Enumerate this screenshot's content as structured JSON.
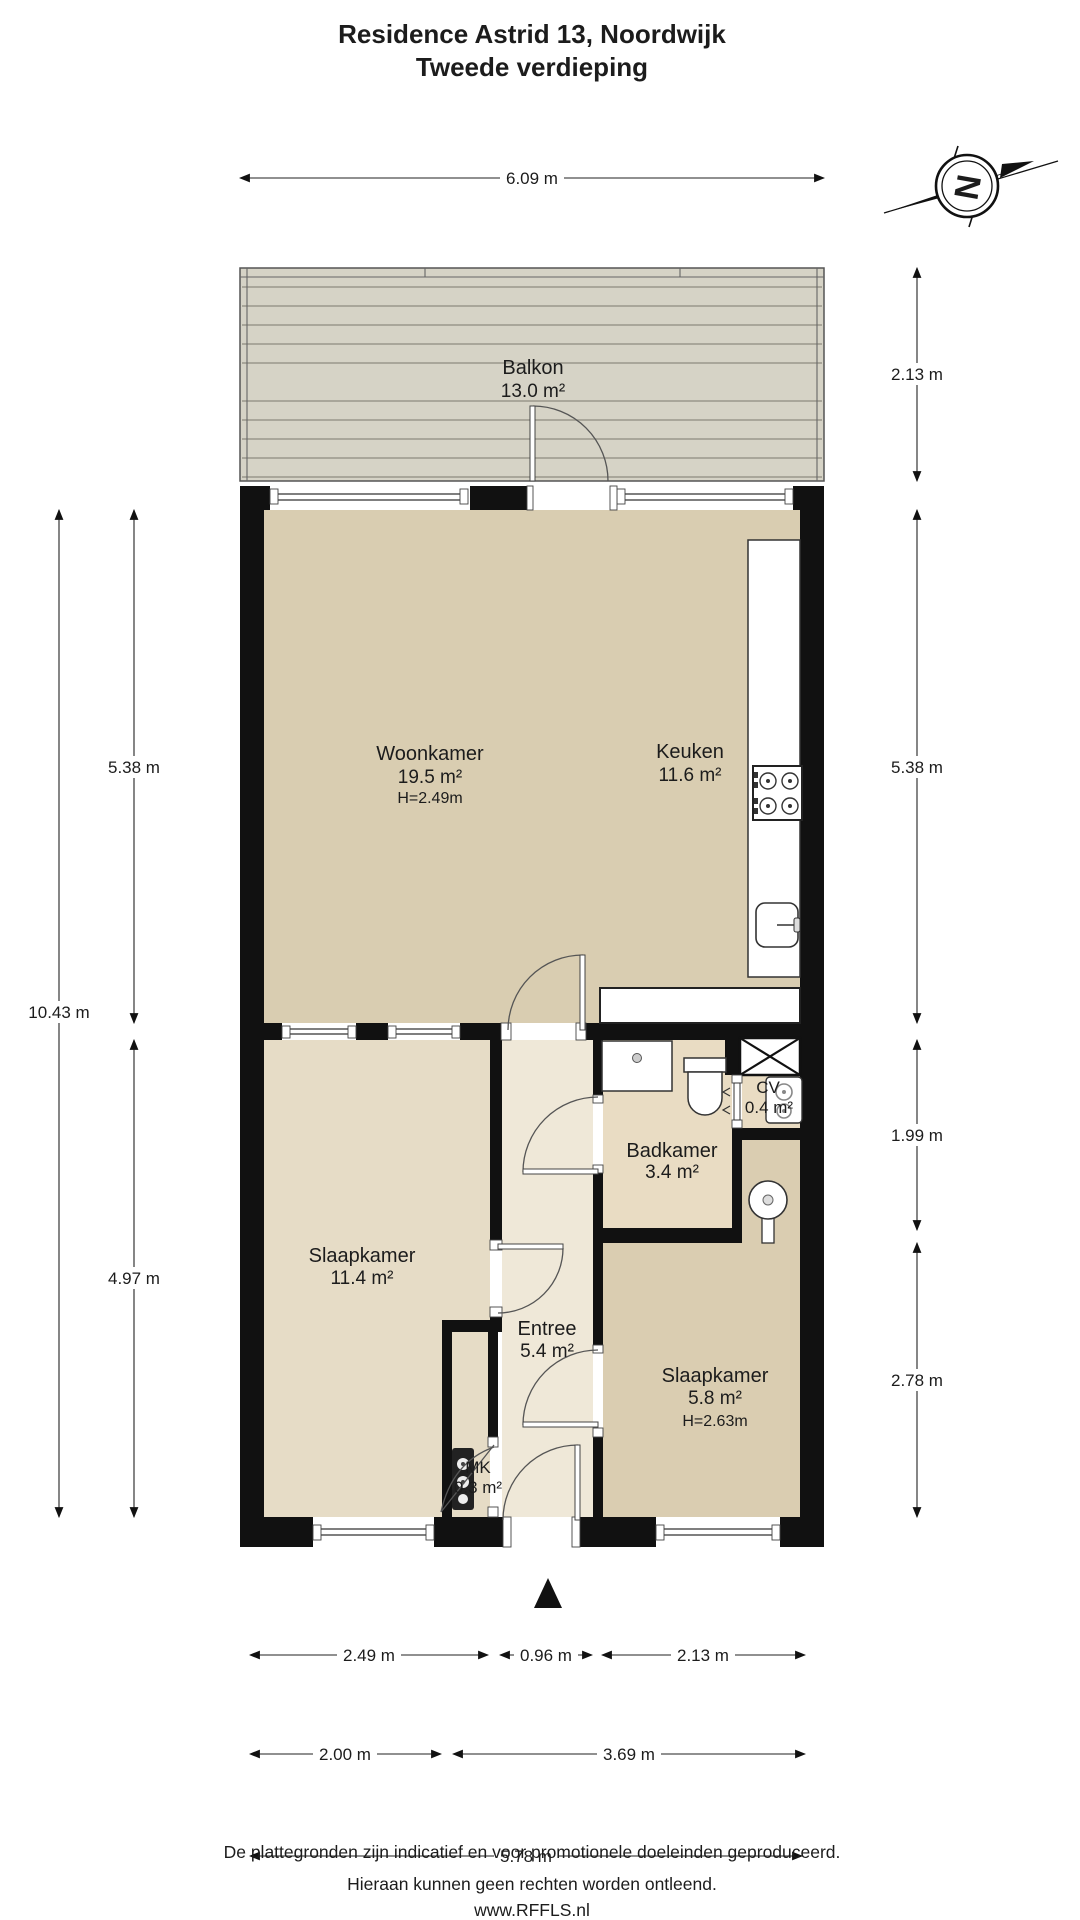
{
  "title": {
    "line1": "Residence Astrid 13, Noordwijk",
    "line2": "Tweede verdieping"
  },
  "compass": {
    "letter": "N"
  },
  "rooms": {
    "balkon": {
      "name": "Balkon",
      "area": "13.0 m²"
    },
    "woonkamer": {
      "name": "Woonkamer",
      "area": "19.5 m²",
      "height": "H=2.49m"
    },
    "keuken": {
      "name": "Keuken",
      "area": "11.6 m²"
    },
    "badkamer": {
      "name": "Badkamer",
      "area": "3.4 m²"
    },
    "cv": {
      "name": "CV",
      "area": "0.4 m²"
    },
    "slaapkamer1": {
      "name": "Slaapkamer",
      "area": "11.4 m²"
    },
    "entree": {
      "name": "Entree",
      "area": "5.4 m²"
    },
    "slaapkamer2": {
      "name": "Slaapkamer",
      "area": "5.8 m²",
      "height": "H=2.63m"
    },
    "mk": {
      "name": "MK",
      "area": "0.3 m²"
    }
  },
  "dimensions": {
    "top": "6.09 m",
    "left_outer": "10.43 m",
    "left_upper": "5.38 m",
    "left_lower": "4.97 m",
    "right_balcony": "2.13 m",
    "right_living": "5.38 m",
    "right_middle": "1.99 m",
    "right_lower": "2.78 m",
    "bottom1a": "2.49 m",
    "bottom1b": "0.96 m",
    "bottom1c": "2.13 m",
    "bottom2a": "2.00 m",
    "bottom2b": "3.69 m",
    "bottom3": "5.78 m"
  },
  "footer": {
    "line1": "De plattegronden zijn indicatief en voor promotionele doeleinden geproduceerd.",
    "line2": "Hieraan kunnen geen rechten worden ontleend.",
    "line3": "www.RFFLS.nl"
  },
  "colors": {
    "living": "#d9cdb1",
    "bedroom1": "#e6dcc6",
    "bedroom2": "#dacdb1",
    "entree": "#efe8d8",
    "bath": "#e9dcc3",
    "deck": "#d6d3c6",
    "wall": "#111111"
  }
}
